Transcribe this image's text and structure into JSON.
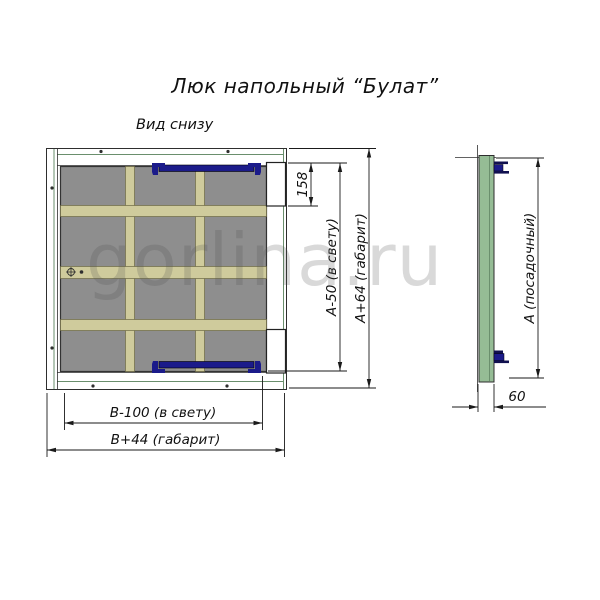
{
  "title": "Люк напольный “Булат”",
  "view_label": "Вид снизу",
  "watermark": "gorlina.ru",
  "dimensions": {
    "latch_height": "158",
    "clear_height": "А-50 (в свету)",
    "overall_height": "А+64 (габарит)",
    "clear_width": "В-100 (в свету)",
    "overall_width": "В+44 (габарит)",
    "seating_height": "А (посадочный)",
    "profile_depth": "60"
  },
  "colors": {
    "frame_green": "#95bc95",
    "panel_gray": "#8e8e8e",
    "rib_beige": "#cfcb9c",
    "hinge_blue": "#1b1b8a",
    "hinge_dark": "#10104f"
  }
}
